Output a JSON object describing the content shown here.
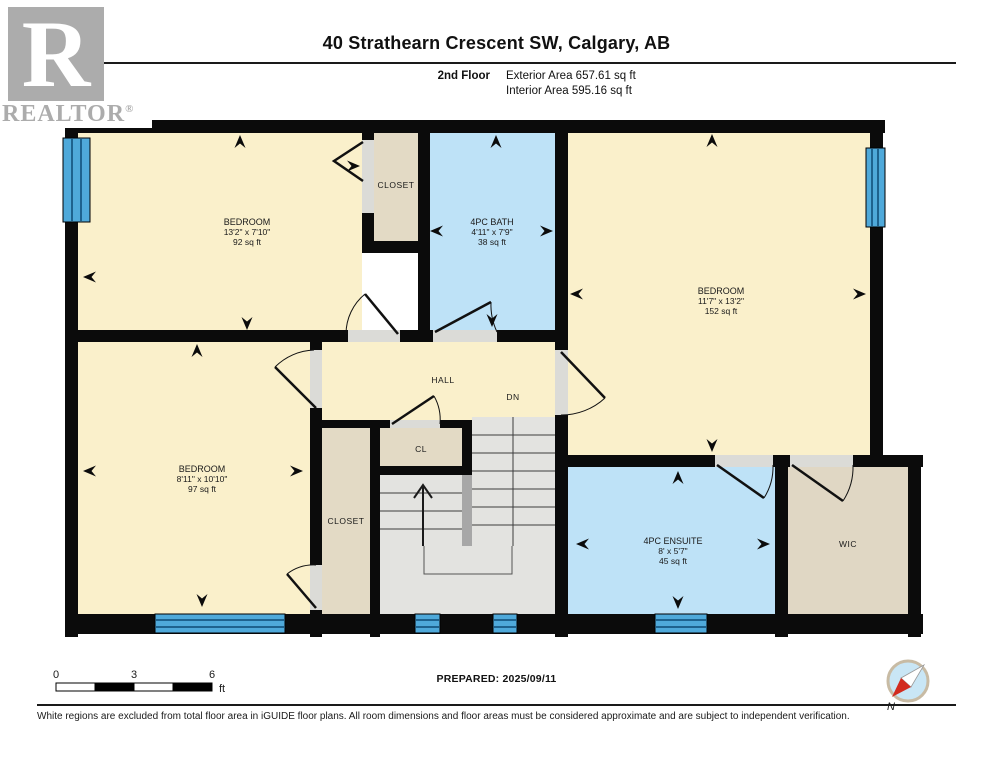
{
  "header": {
    "title": "40 Strathearn Crescent SW, Calgary, AB",
    "floor_label": "2nd Floor",
    "exterior_area": "Exterior Area 657.61 sq ft",
    "interior_area": "Interior Area 595.16 sq ft"
  },
  "logo": {
    "letter": "R",
    "name": "REALTOR",
    "reg": "®"
  },
  "rooms": [
    {
      "name": "BEDROOM",
      "dims": "13'2\" x 7'10\"",
      "area": "92 sq ft"
    },
    {
      "name": "4PC BATH",
      "dims": "4'11\" x 7'9\"",
      "area": "38 sq ft"
    },
    {
      "name": "BEDROOM",
      "dims": "11'7\" x 13'2\"",
      "area": "152 sq ft"
    },
    {
      "name": "BEDROOM",
      "dims": "8'11\" x 10'10\"",
      "area": "97 sq ft"
    },
    {
      "name": "4PC ENSUITE",
      "dims": "8' x 5'7\"",
      "area": "45 sq ft"
    }
  ],
  "labels": {
    "closet_top": "CLOSET",
    "hall": "HALL",
    "dn": "DN",
    "cl": "CL",
    "closet_left": "CLOSET",
    "wic": "WIC"
  },
  "scale": {
    "t0": "0",
    "t3": "3",
    "t6": "6",
    "unit": "ft"
  },
  "footer": {
    "prepared": "PREPARED: 2025/09/11",
    "compass_north": "N",
    "disclaimer": "White regions are excluded from total floor area in iGUIDE floor plans. All room dimensions and floor areas must be considered approximate and are subject to independent verification."
  },
  "colors": {
    "room_cream": "#FAF0CB",
    "room_blue": "#BEE2F7",
    "closet_beige": "#E3DAC5",
    "stairs_gray": "#E3E3E0",
    "threshold_gray": "#DBDBD7",
    "window_blue": "#4FA9DA",
    "wall_black": "#0B0B0B",
    "compass_red": "#D22B1F"
  }
}
